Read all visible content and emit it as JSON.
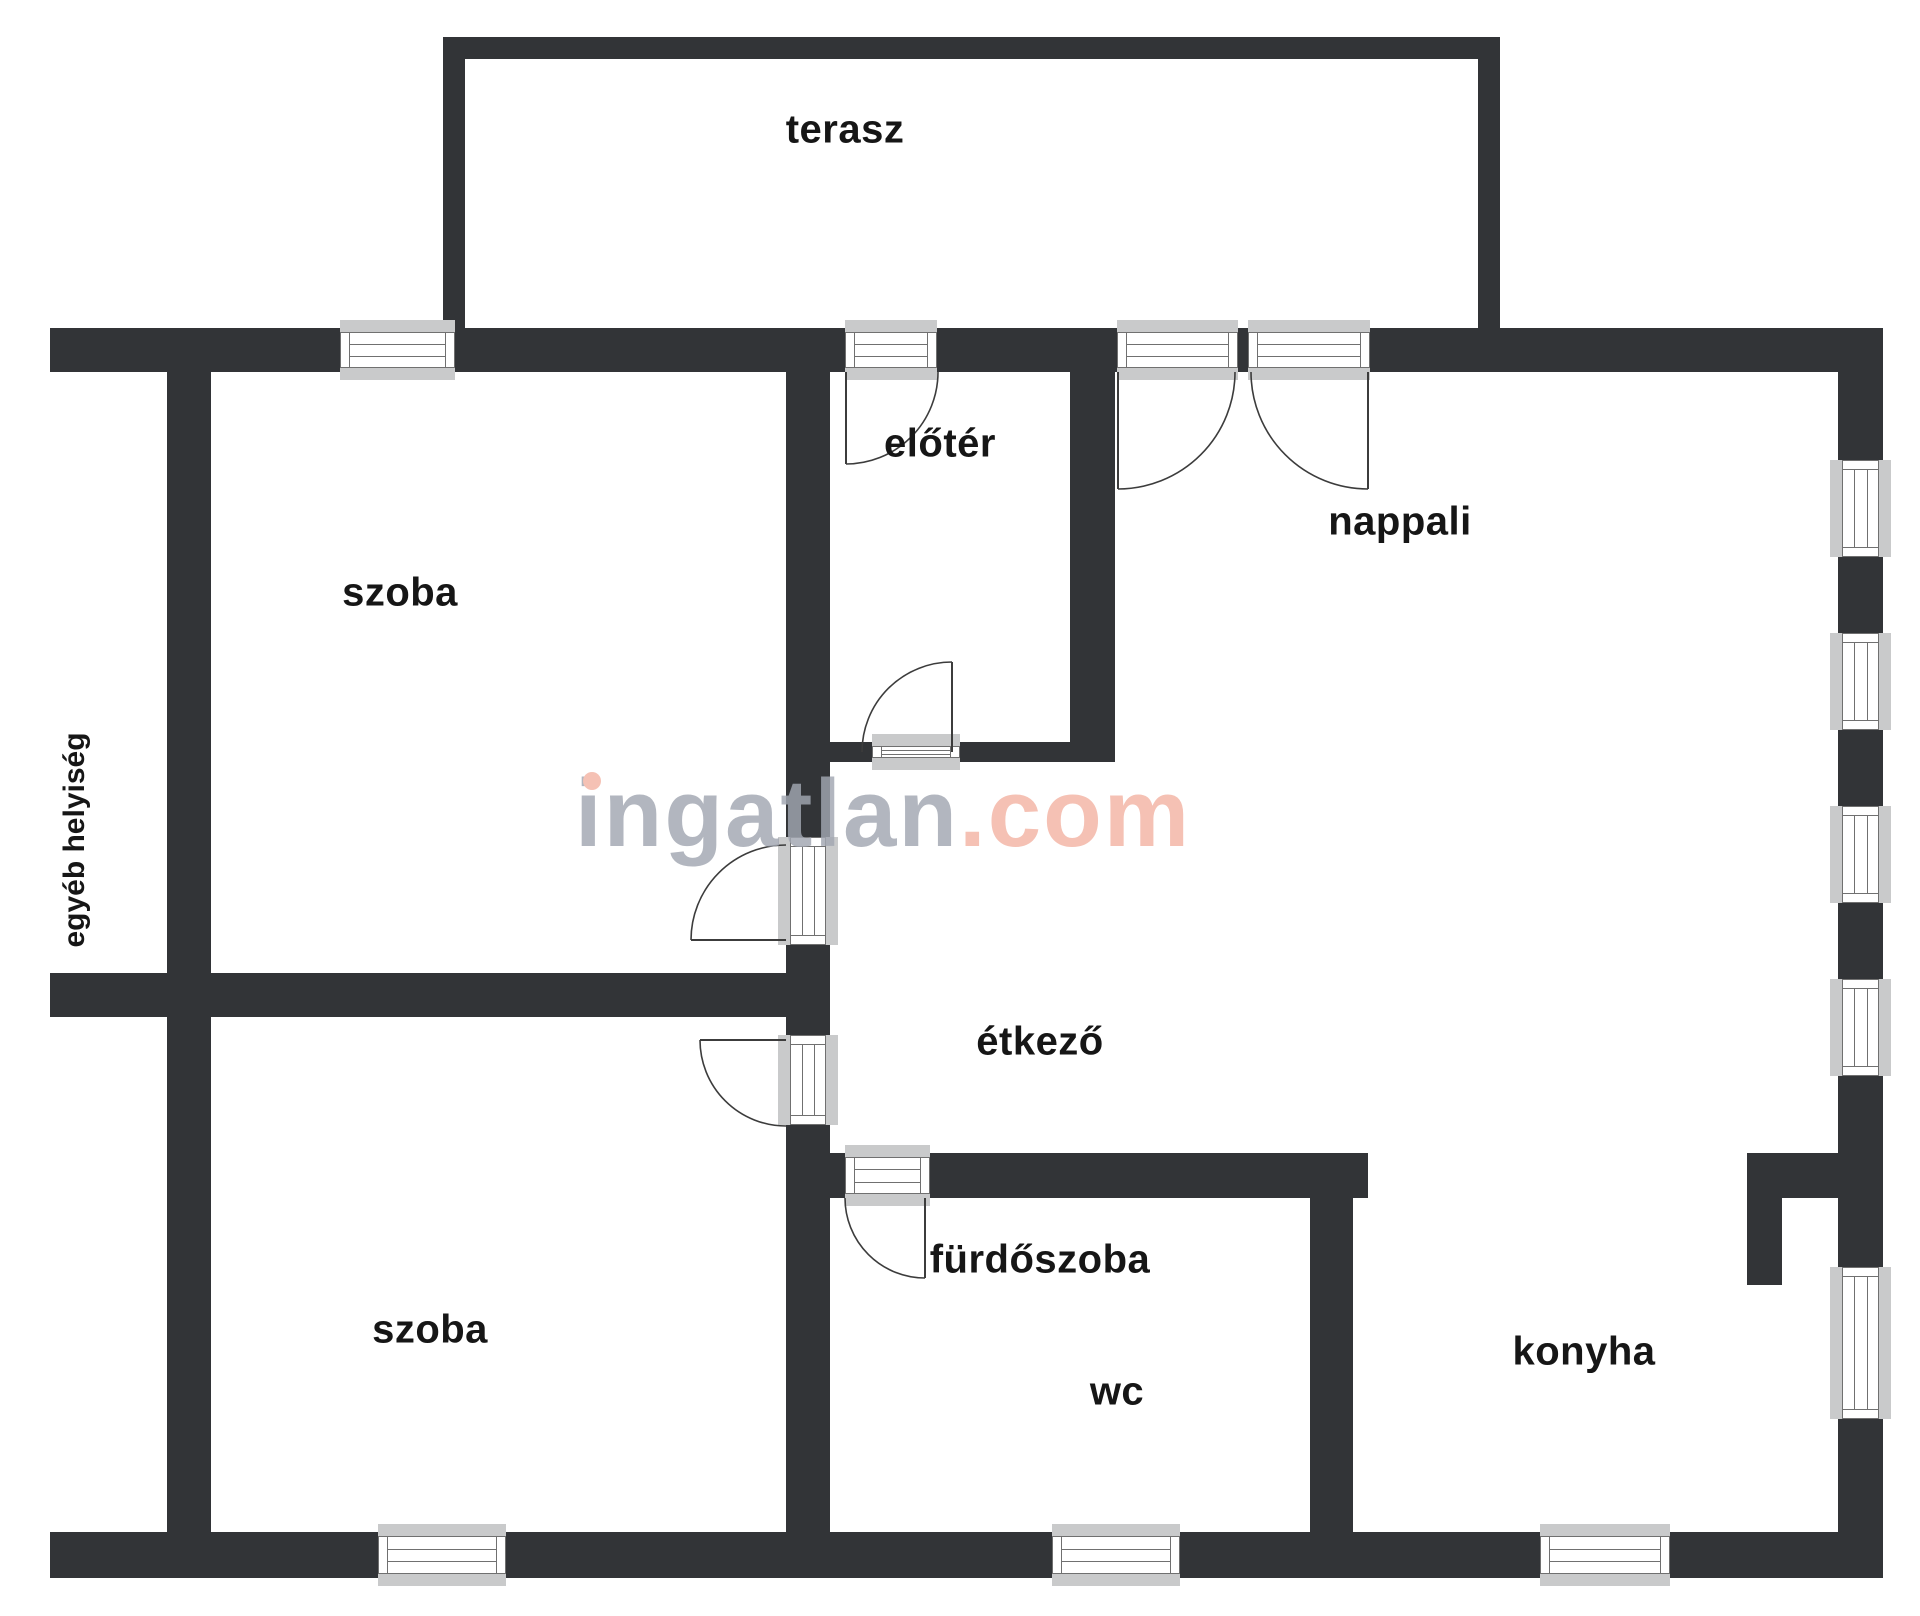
{
  "meta": {
    "width": 1920,
    "height": 1616,
    "background": "#ffffff"
  },
  "colors": {
    "wall": "#323437",
    "window_sill": "#c9cacb",
    "window_frame": "#707070",
    "door_arc": "#3c3c3c",
    "label_text": "#161616",
    "watermark_gray": "#a2a7b2",
    "watermark_salmon": "#f3b4a4"
  },
  "watermark": {
    "gray_text": "ingatlan",
    "pink_text": ".com"
  },
  "side_label": {
    "text": "egyéb helyiség",
    "cx": 75,
    "cy": 840
  },
  "rooms": [
    {
      "id": "terasz",
      "label": "terasz",
      "cx": 845,
      "cy": 130
    },
    {
      "id": "szoba-felso",
      "label": "szoba",
      "cx": 400,
      "cy": 593
    },
    {
      "id": "eloter",
      "label": "előtér",
      "cx": 940,
      "cy": 444
    },
    {
      "id": "nappali",
      "label": "nappali",
      "cx": 1400,
      "cy": 522
    },
    {
      "id": "etkezo",
      "label": "étkező",
      "cx": 1040,
      "cy": 1042
    },
    {
      "id": "szoba-also",
      "label": "szoba",
      "cx": 430,
      "cy": 1330
    },
    {
      "id": "furdoszoba",
      "label": "fürdőszoba",
      "cx": 1040,
      "cy": 1260
    },
    {
      "id": "wc",
      "label": "wc",
      "cx": 1117,
      "cy": 1392
    },
    {
      "id": "konyha",
      "label": "konyha",
      "cx": 1584,
      "cy": 1352
    }
  ],
  "geometry": {
    "walls": [
      [
        443,
        37,
        1057,
        22
      ],
      [
        443,
        37,
        22,
        291
      ],
      [
        1478,
        37,
        22,
        291
      ],
      [
        50,
        328,
        290,
        44
      ],
      [
        455,
        328,
        390,
        44
      ],
      [
        937,
        328,
        180,
        44
      ],
      [
        1238,
        328,
        10,
        44
      ],
      [
        1370,
        328,
        513,
        44
      ],
      [
        167,
        328,
        44,
        1250
      ],
      [
        1838,
        328,
        45,
        132
      ],
      [
        1838,
        557,
        45,
        76
      ],
      [
        1838,
        730,
        45,
        76
      ],
      [
        1838,
        903,
        45,
        76
      ],
      [
        1838,
        1076,
        45,
        191
      ],
      [
        1838,
        1419,
        45,
        159
      ],
      [
        50,
        1532,
        328,
        46
      ],
      [
        506,
        1532,
        546,
        46
      ],
      [
        1180,
        1532,
        360,
        46
      ],
      [
        1670,
        1532,
        213,
        46
      ],
      [
        50,
        973,
        780,
        44
      ],
      [
        786,
        372,
        44,
        465
      ],
      [
        786,
        945,
        44,
        90
      ],
      [
        786,
        1125,
        44,
        407
      ],
      [
        830,
        742,
        42,
        20
      ],
      [
        960,
        742,
        110,
        20
      ],
      [
        1070,
        372,
        45,
        390
      ],
      [
        830,
        1153,
        15,
        45
      ],
      [
        930,
        1153,
        438,
        45
      ],
      [
        1310,
        1198,
        43,
        334
      ],
      [
        1747,
        1153,
        91,
        45
      ],
      [
        1747,
        1198,
        35,
        87
      ]
    ],
    "windows": [
      {
        "x": 340,
        "y": 328,
        "w": 115,
        "h": 44,
        "o": "h"
      },
      {
        "x": 845,
        "y": 328,
        "w": 92,
        "h": 44,
        "o": "h"
      },
      {
        "x": 1117,
        "y": 328,
        "w": 121,
        "h": 44,
        "o": "h"
      },
      {
        "x": 1248,
        "y": 328,
        "w": 122,
        "h": 44,
        "o": "h"
      },
      {
        "x": 378,
        "y": 1532,
        "w": 128,
        "h": 46,
        "o": "h"
      },
      {
        "x": 1052,
        "y": 1532,
        "w": 128,
        "h": 46,
        "o": "h"
      },
      {
        "x": 1540,
        "y": 1532,
        "w": 130,
        "h": 46,
        "o": "h"
      },
      {
        "x": 872,
        "y": 742,
        "w": 88,
        "h": 20,
        "o": "h"
      },
      {
        "x": 845,
        "y": 1153,
        "w": 85,
        "h": 45,
        "o": "h"
      },
      {
        "x": 1838,
        "y": 460,
        "w": 45,
        "h": 97,
        "o": "v"
      },
      {
        "x": 1838,
        "y": 633,
        "w": 45,
        "h": 97,
        "o": "v"
      },
      {
        "x": 1838,
        "y": 806,
        "w": 45,
        "h": 97,
        "o": "v"
      },
      {
        "x": 1838,
        "y": 979,
        "w": 45,
        "h": 97,
        "o": "v"
      },
      {
        "x": 1838,
        "y": 1267,
        "w": 45,
        "h": 152,
        "o": "v"
      },
      {
        "x": 786,
        "y": 837,
        "w": 44,
        "h": 108,
        "o": "v"
      },
      {
        "x": 786,
        "y": 1035,
        "w": 44,
        "h": 90,
        "o": "v"
      }
    ],
    "doors": [
      {
        "hinge": [
          846,
          372
        ],
        "leaf": [
          846,
          464
        ],
        "r": 92,
        "end": [
          938,
          372
        ],
        "sweep": 0
      },
      {
        "hinge": [
          1118,
          372
        ],
        "leaf": [
          1118,
          489
        ],
        "r": 117,
        "end": [
          1235,
          372
        ],
        "sweep": 0
      },
      {
        "hinge": [
          1368,
          372
        ],
        "leaf": [
          1368,
          489
        ],
        "r": 117,
        "end": [
          1251,
          372
        ],
        "sweep": 1
      },
      {
        "hinge": [
          952,
          752
        ],
        "leaf": [
          952,
          662
        ],
        "r": 90,
        "end": [
          862,
          752
        ],
        "sweep": 0
      },
      {
        "hinge": [
          786,
          940
        ],
        "leaf": [
          691,
          940
        ],
        "r": 95,
        "end": [
          786,
          845
        ],
        "sweep": 1
      },
      {
        "hinge": [
          786,
          1040
        ],
        "leaf": [
          700,
          1040
        ],
        "r": 86,
        "end": [
          786,
          1126
        ],
        "sweep": 0
      },
      {
        "hinge": [
          925,
          1198
        ],
        "leaf": [
          925,
          1278
        ],
        "r": 80,
        "end": [
          845,
          1198
        ],
        "sweep": 1
      }
    ]
  }
}
